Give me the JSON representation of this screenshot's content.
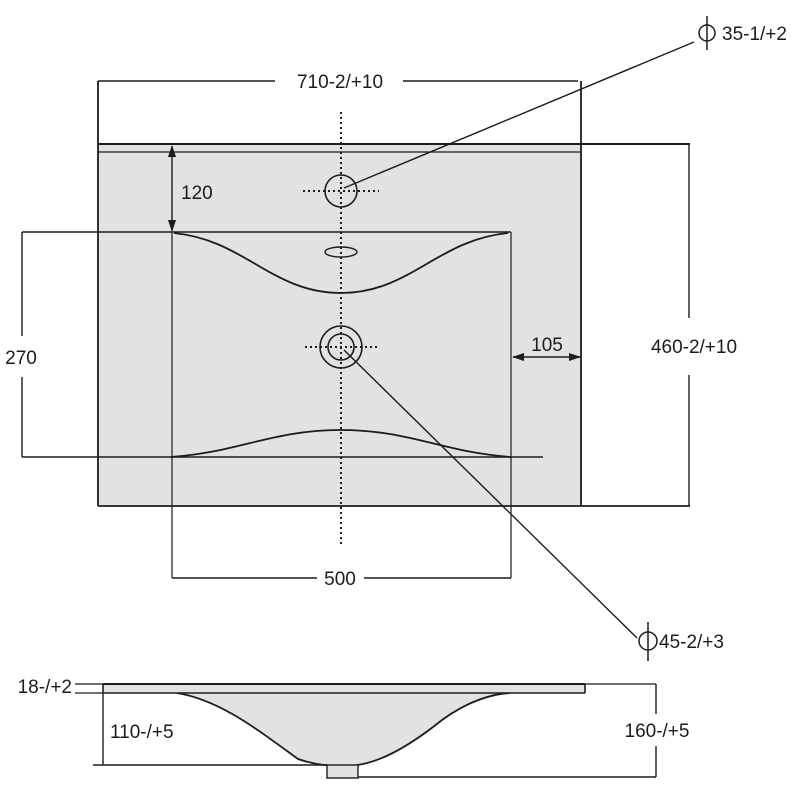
{
  "drawing": {
    "type": "technical-dimension-drawing",
    "subject": "washbasin plan and section views",
    "colors": {
      "line": "#1c1c1c",
      "fill_light": "#e2e2e2",
      "background": "#ffffff"
    },
    "plan_view": {
      "overall_width": "710-2/+10",
      "overall_depth": "460-2/+10",
      "tap_ledge_depth": "120",
      "bowl_depth": "270",
      "bowl_width": "500",
      "side_ledge_width": "105",
      "faucet_hole_diameter": "35-1/+2",
      "drain_hole_diameter": "45-2/+3",
      "diameter_symbol": "⌀"
    },
    "section_view": {
      "rim_thickness": "18-/+2",
      "bowl_inner_depth": "110-/+5",
      "overall_height": "160-/+5"
    }
  }
}
